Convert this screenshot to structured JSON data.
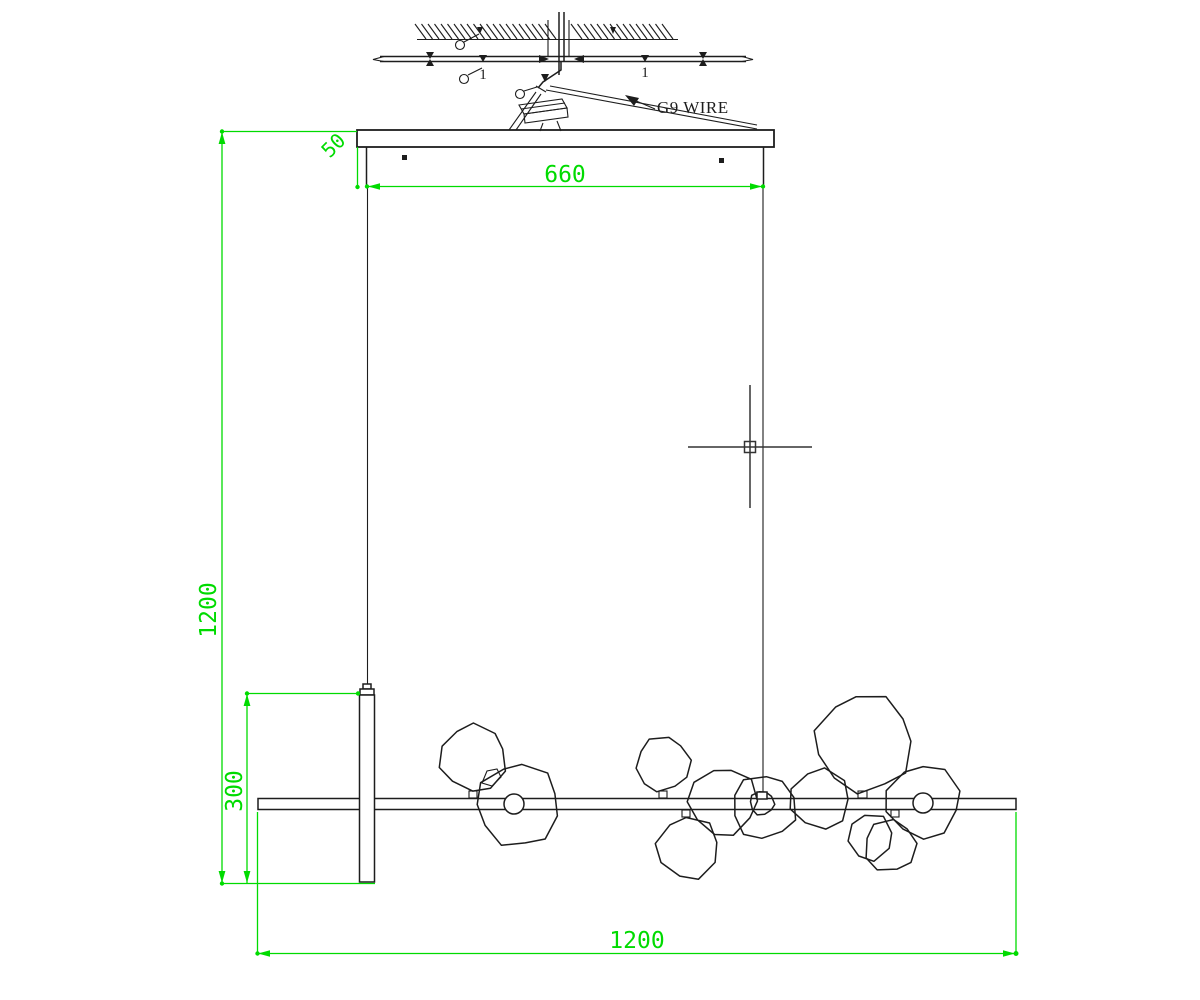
{
  "drawing": {
    "type": "cad-installation-drawing",
    "subject": "linear bubble chandelier suspension installation detail",
    "colors": {
      "dimension_green": "#00DB00",
      "line_black": "#1d1d1d",
      "cursor_gray": "#333333",
      "background": "#ffffff"
    },
    "labels": {
      "wire_callout": "G9 WIRE",
      "ceiling_mark_left": "1",
      "ceiling_mark_right": "1"
    },
    "dimensions": {
      "canopy_width": "660",
      "canopy_drop": "50",
      "suspension_height": "1200",
      "end_stem_height": "300",
      "fixture_length": "1200"
    },
    "hatch": {
      "x_start": 415,
      "x_end": 664,
      "y_top": 24,
      "y_bottom": 39,
      "step": 6.5,
      "gap_start": 547,
      "gap_end": 569,
      "slant": 11
    },
    "bubbles": [
      {
        "cx": 473,
        "cy": 758,
        "r": 33,
        "n": 10,
        "seed": 1
      },
      {
        "cx": 518,
        "cy": 805,
        "r": 41,
        "n": 11,
        "seed": 2
      },
      {
        "cx": 663,
        "cy": 764,
        "r": 27,
        "n": 10,
        "seed": 3
      },
      {
        "cx": 688,
        "cy": 848,
        "r": 31,
        "n": 9,
        "seed": 4
      },
      {
        "cx": 723,
        "cy": 801,
        "r": 34,
        "n": 10,
        "seed": 5
      },
      {
        "cx": 764,
        "cy": 807,
        "r": 32,
        "n": 10,
        "seed": 6
      },
      {
        "cx": 820,
        "cy": 799,
        "r": 30,
        "n": 9,
        "seed": 7
      },
      {
        "cx": 864,
        "cy": 743,
        "r": 48,
        "n": 11,
        "seed": 8
      },
      {
        "cx": 890,
        "cy": 846,
        "r": 26,
        "n": 9,
        "seed": 9
      },
      {
        "cx": 870,
        "cy": 837,
        "r": 23,
        "n": 8,
        "seed": 10
      },
      {
        "cx": 923,
        "cy": 801,
        "r": 37,
        "n": 10,
        "seed": 11
      },
      {
        "cx": 762,
        "cy": 803,
        "r": 12,
        "n": 10,
        "seed": 12
      }
    ]
  }
}
